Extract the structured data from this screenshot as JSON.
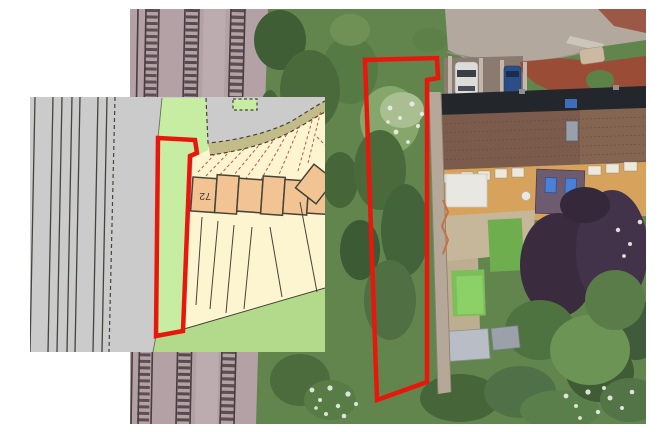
{
  "figure": {
    "type": "composite aerial photograph with cadastral plan inset",
    "house_number_label": "72"
  },
  "colors": {
    "page_bg": "#ffffff",
    "boundary_red": "#e8170d",
    "map_gray": "#cbcbcb",
    "map_green": "#c6eda2",
    "map_bottom_green": "#b2da8a",
    "map_parcel_yellow": "#fcf5cf",
    "map_building_orange": "#f2c493",
    "map_verge_olive": "#c2bd88",
    "map_line_dark": "#45433a",
    "map_fan_red": "#cf5340"
  }
}
